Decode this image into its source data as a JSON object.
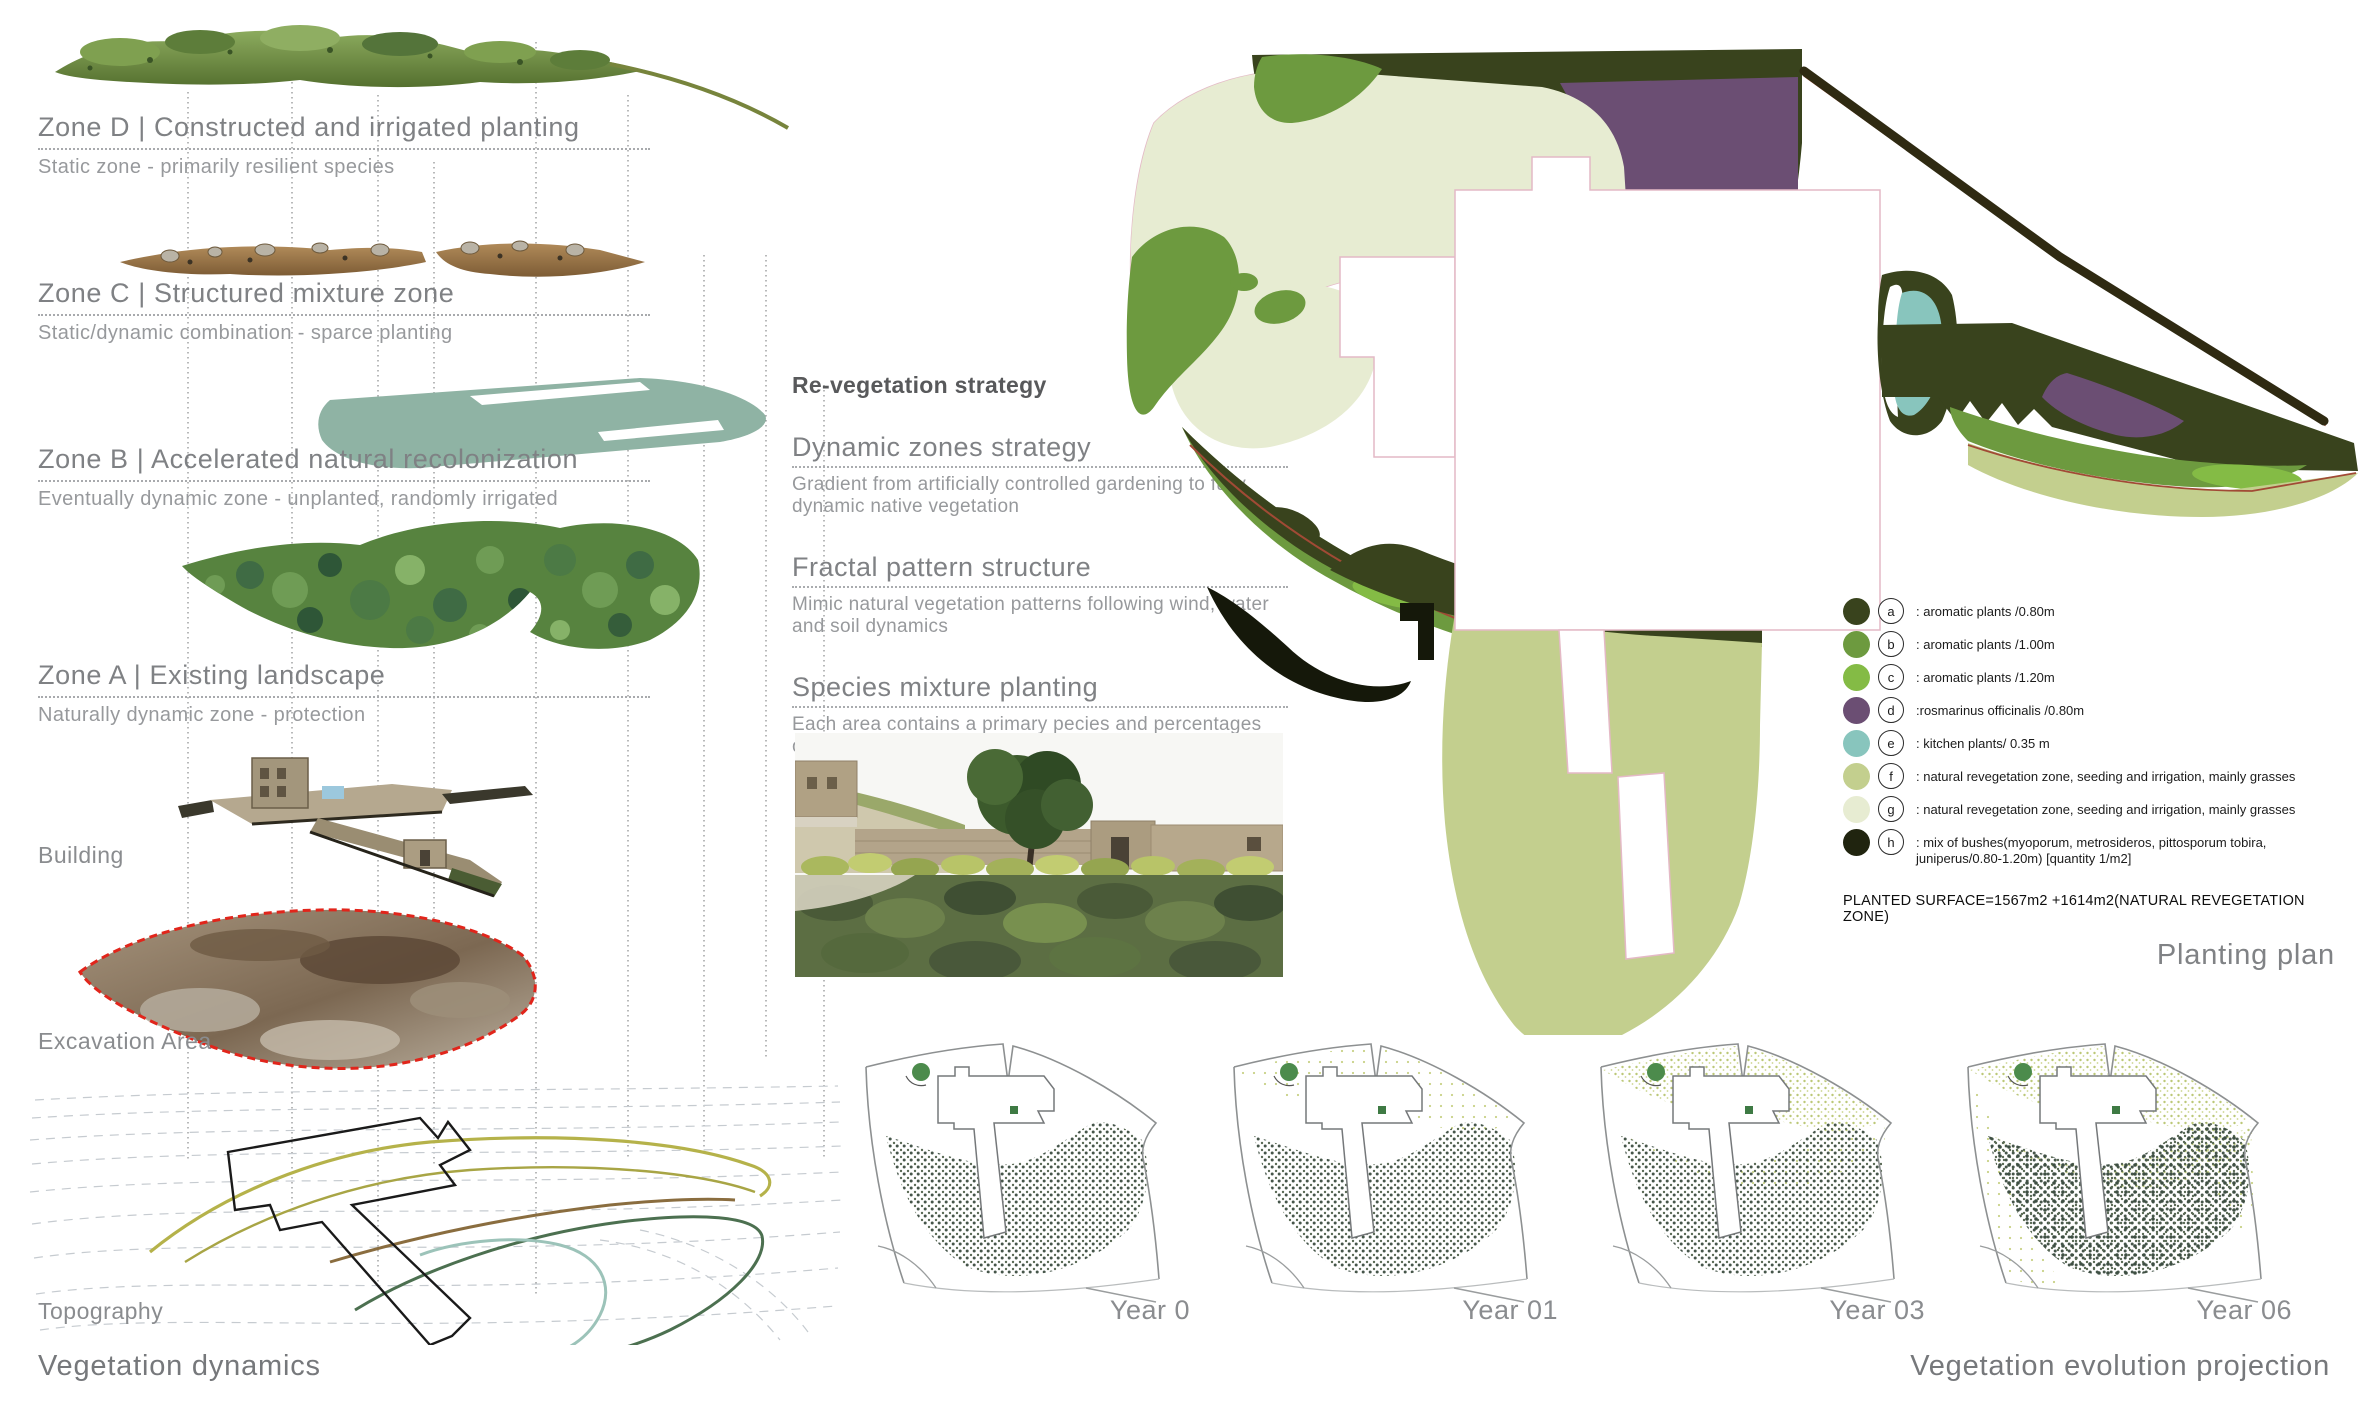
{
  "vegetation_dynamics": {
    "title": "Vegetation dynamics",
    "zones": [
      {
        "title": "Zone D | Constructed and irrigated planting",
        "subtitle": "Static zone - primarily resilient species"
      },
      {
        "title": "Zone C | Structured mixture zone",
        "subtitle": "Static/dynamic combination - sparce planting"
      },
      {
        "title": "Zone B | Accelerated natural recolonization",
        "subtitle": "Eventually dynamic zone - unplanted, randomly irrigated"
      },
      {
        "title": "Zone A | Existing landscape",
        "subtitle": "Naturally dynamic zone - protection"
      }
    ],
    "layer_labels": [
      "Building",
      "Excavation Area",
      "Topography"
    ]
  },
  "strategy": {
    "title": "Re-vegetation strategy",
    "sections": [
      {
        "heading": "Dynamic zones strategy",
        "body": "Gradient from artificially controlled gardening to fully dynamic native vegetation"
      },
      {
        "heading": "Fractal pattern structure",
        "body": "Mimic natural vegetation patterns following wind, water and soil dynamics"
      },
      {
        "heading": "Species mixture planting",
        "body": "Each area contains a primary pecies and percentages of adjoining areas species"
      }
    ]
  },
  "planting_plan": {
    "title": "Planting plan",
    "planted_surface": "PLANTED SURFACE=1567m2 +1614m2(NATURAL REVEGETATION ZONE)",
    "legend": [
      {
        "letter": "a",
        "color": "#39431d",
        "label": ": aromatic plants /0.80m"
      },
      {
        "letter": "b",
        "color": "#6d9a3f",
        "label": ": aromatic plants /1.00m"
      },
      {
        "letter": "c",
        "color": "#84bb45",
        "label": ": aromatic plants /1.20m"
      },
      {
        "letter": "d",
        "color": "#6b4e73",
        "label": ":rosmarinus officinalis /0.80m"
      },
      {
        "letter": "e",
        "color": "#88c5bd",
        "label": ": kitchen plants/ 0.35 m"
      },
      {
        "letter": "f",
        "color": "#c3cf8e",
        "label": ": natural revegetation zone, seeding and irrigation, mainly grasses"
      },
      {
        "letter": "g",
        "color": "#e7ecd2",
        "label": ": natural revegetation zone, seeding and irrigation, mainly grasses"
      },
      {
        "letter": "h",
        "color": "#20240f",
        "label": ": mix of bushes(myoporum, metrosideros, pittosporum tobira, juniperus/0.80-1.20m) [quantity 1/m2]"
      }
    ]
  },
  "evolution": {
    "title": "Vegetation evolution projection",
    "years": [
      "Year 0",
      "Year 01",
      "Year 03",
      "Year 06"
    ]
  }
}
